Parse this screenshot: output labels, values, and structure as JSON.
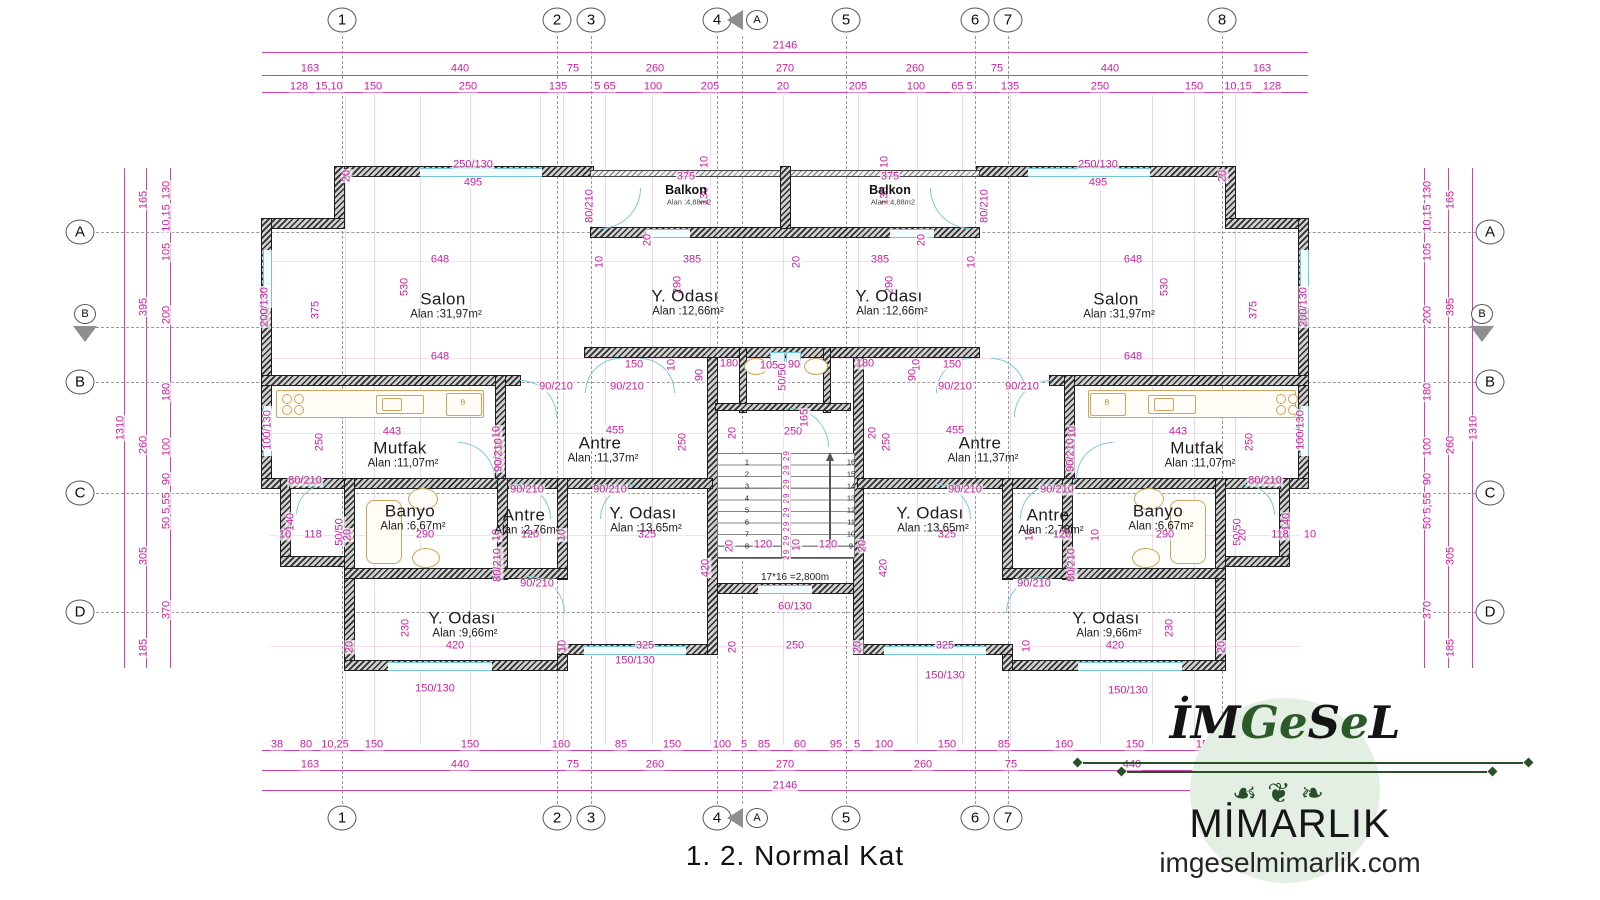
{
  "title": "1. 2. Normal Kat",
  "logo": {
    "parts": [
      {
        "t": "İ",
        "c": "k"
      },
      {
        "t": "M",
        "c": "k"
      },
      {
        "t": "G",
        "c": "g"
      },
      {
        "t": "e",
        "c": "g"
      },
      {
        "t": "S",
        "c": "k"
      },
      {
        "t": "e",
        "c": "g"
      },
      {
        "t": "L",
        "c": "k"
      }
    ],
    "flourish": "☙❦❧",
    "subtitle": "MİMARLIK",
    "website": "imgeselmimarlik.com"
  },
  "colors": {
    "dimension": "#cb1ea0",
    "wall": "#2e2e2e",
    "window": "#74c6d6",
    "fixture": "#cfa45f",
    "logo_green": "#27502a",
    "logo_bg": "#e3efe3"
  },
  "grid": {
    "top_y": 20,
    "bottom_y": 818,
    "left_x": 80,
    "right_x": 1490,
    "cols": [
      {
        "label": "1",
        "x": 342
      },
      {
        "label": "2",
        "x": 557
      },
      {
        "label": "3",
        "x": 591
      },
      {
        "label": "4",
        "x": 717
      },
      {
        "label": "5",
        "x": 846
      },
      {
        "label": "6",
        "x": 975
      },
      {
        "label": "7",
        "x": 1008
      },
      {
        "label": "8",
        "x": 1222
      }
    ],
    "rows": [
      {
        "label": "A",
        "y": 232
      },
      {
        "label": "B",
        "y": 382
      },
      {
        "label": "C",
        "y": 493
      },
      {
        "label": "D",
        "y": 612
      }
    ],
    "markers": [
      {
        "label": "A",
        "cx": 757,
        "cy": 20,
        "tri": "left",
        "tx": 727,
        "ty": 10
      },
      {
        "label": "A",
        "cx": 757,
        "cy": 818,
        "tri": "left",
        "tx": 727,
        "ty": 808
      },
      {
        "label": "B",
        "cx": 85,
        "cy": 314,
        "tri": "down",
        "tx": 73,
        "ty": 326
      },
      {
        "label": "B",
        "cx": 1482,
        "cy": 314,
        "tri": "down",
        "tx": 1470,
        "ty": 326
      }
    ],
    "section_lines": {
      "vertical_x": 742,
      "horizontal_y": 327
    }
  },
  "rooms": [
    {
      "name": "Salon",
      "area": "Alan :31,97m²",
      "x": 443,
      "y": 299
    },
    {
      "name": "Y. Odası",
      "area": "Alan :12,66m²",
      "x": 685,
      "y": 296
    },
    {
      "name": "Y. Odası",
      "area": "Alan :12,66m²",
      "x": 889,
      "y": 296
    },
    {
      "name": "Salon",
      "area": "Alan :31,97m²",
      "x": 1116,
      "y": 299
    },
    {
      "name": "Balkon",
      "area": "Alan :4,88m2",
      "x": 686,
      "y": 190,
      "small": true
    },
    {
      "name": "Balkon",
      "area": "Alan :4,88m2",
      "x": 890,
      "y": 190,
      "small": true
    },
    {
      "name": "Mutfak",
      "area": "Alan :11,07m²",
      "x": 400,
      "y": 448
    },
    {
      "name": "Antre",
      "area": "Alan :11,37m²",
      "x": 600,
      "y": 443
    },
    {
      "name": "Antre",
      "area": "Alan :11,37m²",
      "x": 980,
      "y": 443
    },
    {
      "name": "Mutfak",
      "area": "Alan :11,07m²",
      "x": 1197,
      "y": 448
    },
    {
      "name": "Banyo",
      "area": "Alan :6,67m²",
      "x": 410,
      "y": 511
    },
    {
      "name": "Antre",
      "area": "Alan :2,76m²",
      "x": 524,
      "y": 515
    },
    {
      "name": "Y. Odası",
      "area": "Alan :13,65m²",
      "x": 643,
      "y": 513
    },
    {
      "name": "Y. Odası",
      "area": "Alan :13,65m²",
      "x": 930,
      "y": 513
    },
    {
      "name": "Antre",
      "area": "Alan :2,76m²",
      "x": 1048,
      "y": 515
    },
    {
      "name": "Banyo",
      "area": "Alan :6,67m²",
      "x": 1158,
      "y": 511
    },
    {
      "name": "Y. Odası",
      "area": "Alan :9,66m²",
      "x": 462,
      "y": 618
    },
    {
      "name": "Y. Odası",
      "area": "Alan :9,66m²",
      "x": 1106,
      "y": 618
    }
  ],
  "stair": {
    "note": "17*16 =2,800m",
    "left_steps": [
      "1",
      "2",
      "3",
      "4",
      "5",
      "6",
      "7",
      "8"
    ],
    "right_steps": [
      "16",
      "15",
      "14",
      "13",
      "12",
      "11",
      "10",
      "9"
    ],
    "riser_labels": "29 29 29 29 29 29 29 29"
  },
  "labels": [
    {
      "t": "2146",
      "x": 785,
      "y": 46
    },
    {
      "t": "163",
      "x": 310,
      "y": 69
    },
    {
      "t": "440",
      "x": 460,
      "y": 69
    },
    {
      "t": "75",
      "x": 573,
      "y": 69
    },
    {
      "t": "260",
      "x": 655,
      "y": 69
    },
    {
      "t": "270",
      "x": 785,
      "y": 69
    },
    {
      "t": "260",
      "x": 915,
      "y": 69
    },
    {
      "t": "75",
      "x": 997,
      "y": 69
    },
    {
      "t": "440",
      "x": 1110,
      "y": 69
    },
    {
      "t": "163",
      "x": 1262,
      "y": 69
    },
    {
      "t": "128",
      "x": 299,
      "y": 87
    },
    {
      "t": "15,10",
      "x": 329,
      "y": 87
    },
    {
      "t": "150",
      "x": 373,
      "y": 87
    },
    {
      "t": "250",
      "x": 468,
      "y": 87
    },
    {
      "t": "135",
      "x": 558,
      "y": 87
    },
    {
      "t": "5 65",
      "x": 605,
      "y": 87
    },
    {
      "t": "100",
      "x": 653,
      "y": 87
    },
    {
      "t": "205",
      "x": 710,
      "y": 87
    },
    {
      "t": "20",
      "x": 783,
      "y": 87
    },
    {
      "t": "205",
      "x": 858,
      "y": 87
    },
    {
      "t": "100",
      "x": 916,
      "y": 87
    },
    {
      "t": "65 5",
      "x": 962,
      "y": 87
    },
    {
      "t": "135",
      "x": 1010,
      "y": 87
    },
    {
      "t": "250",
      "x": 1100,
      "y": 87
    },
    {
      "t": "150",
      "x": 1194,
      "y": 87
    },
    {
      "t": "10,15",
      "x": 1238,
      "y": 87
    },
    {
      "t": "128",
      "x": 1272,
      "y": 87
    },
    {
      "t": "38",
      "x": 277,
      "y": 745
    },
    {
      "t": "80",
      "x": 306,
      "y": 745
    },
    {
      "t": "10,25",
      "x": 335,
      "y": 745
    },
    {
      "t": "150",
      "x": 374,
      "y": 745
    },
    {
      "t": "150",
      "x": 470,
      "y": 745
    },
    {
      "t": "160",
      "x": 561,
      "y": 745
    },
    {
      "t": "85",
      "x": 621,
      "y": 745
    },
    {
      "t": "150",
      "x": 672,
      "y": 745
    },
    {
      "t": "100",
      "x": 722,
      "y": 745
    },
    {
      "t": "5",
      "x": 744,
      "y": 745
    },
    {
      "t": "85",
      "x": 764,
      "y": 745
    },
    {
      "t": "60",
      "x": 800,
      "y": 745
    },
    {
      "t": "95",
      "x": 836,
      "y": 745
    },
    {
      "t": "5",
      "x": 857,
      "y": 745
    },
    {
      "t": "100",
      "x": 884,
      "y": 745
    },
    {
      "t": "150",
      "x": 947,
      "y": 745
    },
    {
      "t": "85",
      "x": 1004,
      "y": 745
    },
    {
      "t": "160",
      "x": 1064,
      "y": 745
    },
    {
      "t": "150",
      "x": 1135,
      "y": 745
    },
    {
      "t": "150",
      "x": 1205,
      "y": 745
    },
    {
      "t": "25,080",
      "x": 1262,
      "y": 745
    },
    {
      "t": "38",
      "x": 1300,
      "y": 745
    },
    {
      "t": "163",
      "x": 310,
      "y": 765
    },
    {
      "t": "440",
      "x": 460,
      "y": 765
    },
    {
      "t": "75",
      "x": 573,
      "y": 765
    },
    {
      "t": "260",
      "x": 655,
      "y": 765
    },
    {
      "t": "270",
      "x": 785,
      "y": 765
    },
    {
      "t": "260",
      "x": 923,
      "y": 765
    },
    {
      "t": "75",
      "x": 1011,
      "y": 765
    },
    {
      "t": "440",
      "x": 1132,
      "y": 765
    },
    {
      "t": "163",
      "x": 1280,
      "y": 765
    },
    {
      "t": "2146",
      "x": 785,
      "y": 786
    },
    {
      "t": "130",
      "x": 167,
      "y": 190,
      "r": 1
    },
    {
      "t": "10,15",
      "x": 167,
      "y": 218,
      "r": 1
    },
    {
      "t": "105",
      "x": 167,
      "y": 252,
      "r": 1
    },
    {
      "t": "200",
      "x": 167,
      "y": 315,
      "r": 1
    },
    {
      "t": "180",
      "x": 167,
      "y": 392,
      "r": 1
    },
    {
      "t": "100",
      "x": 167,
      "y": 447,
      "r": 1
    },
    {
      "t": "90",
      "x": 167,
      "y": 479,
      "r": 1
    },
    {
      "t": "5,55",
      "x": 167,
      "y": 503,
      "r": 1
    },
    {
      "t": "50",
      "x": 167,
      "y": 523,
      "r": 1
    },
    {
      "t": "370",
      "x": 167,
      "y": 610,
      "r": 1
    },
    {
      "t": "165",
      "x": 144,
      "y": 200,
      "r": 1
    },
    {
      "t": "395",
      "x": 144,
      "y": 307,
      "r": 1
    },
    {
      "t": "260",
      "x": 144,
      "y": 445,
      "r": 1
    },
    {
      "t": "305",
      "x": 144,
      "y": 556,
      "r": 1
    },
    {
      "t": "185",
      "x": 144,
      "y": 648,
      "r": 1
    },
    {
      "t": "1310",
      "x": 121,
      "y": 428,
      "r": 1
    },
    {
      "t": "130",
      "x": 1428,
      "y": 190,
      "r": 1
    },
    {
      "t": "10,15",
      "x": 1428,
      "y": 218,
      "r": 1
    },
    {
      "t": "105",
      "x": 1428,
      "y": 252,
      "r": 1
    },
    {
      "t": "200",
      "x": 1428,
      "y": 315,
      "r": 1
    },
    {
      "t": "180",
      "x": 1428,
      "y": 392,
      "r": 1
    },
    {
      "t": "100",
      "x": 1428,
      "y": 447,
      "r": 1
    },
    {
      "t": "90",
      "x": 1428,
      "y": 479,
      "r": 1
    },
    {
      "t": "5,55",
      "x": 1428,
      "y": 503,
      "r": 1
    },
    {
      "t": "50",
      "x": 1428,
      "y": 523,
      "r": 1
    },
    {
      "t": "370",
      "x": 1428,
      "y": 610,
      "r": 1
    },
    {
      "t": "165",
      "x": 1451,
      "y": 200,
      "r": 1
    },
    {
      "t": "395",
      "x": 1451,
      "y": 307,
      "r": 1
    },
    {
      "t": "260",
      "x": 1451,
      "y": 445,
      "r": 1
    },
    {
      "t": "305",
      "x": 1451,
      "y": 556,
      "r": 1
    },
    {
      "t": "185",
      "x": 1451,
      "y": 648,
      "r": 1
    },
    {
      "t": "1310",
      "x": 1474,
      "y": 428,
      "r": 1
    },
    {
      "t": "250/130",
      "x": 473,
      "y": 165
    },
    {
      "t": "495",
      "x": 473,
      "y": 183
    },
    {
      "t": "250/130",
      "x": 1098,
      "y": 165
    },
    {
      "t": "495",
      "x": 1098,
      "y": 183
    },
    {
      "t": "375",
      "x": 686,
      "y": 177
    },
    {
      "t": "375",
      "x": 890,
      "y": 177
    },
    {
      "t": "10",
      "x": 705,
      "y": 162,
      "r": 1
    },
    {
      "t": "130",
      "x": 705,
      "y": 196,
      "r": 1
    },
    {
      "t": "10",
      "x": 885,
      "y": 162,
      "r": 1
    },
    {
      "t": "130",
      "x": 885,
      "y": 196,
      "r": 1
    },
    {
      "t": "20",
      "x": 347,
      "y": 176,
      "r": 1
    },
    {
      "t": "20",
      "x": 1223,
      "y": 176,
      "r": 1
    },
    {
      "t": "80/210",
      "x": 590,
      "y": 206,
      "r": 1
    },
    {
      "t": "80/210",
      "x": 985,
      "y": 206,
      "r": 1
    },
    {
      "t": "20",
      "x": 648,
      "y": 240,
      "r": 1
    },
    {
      "t": "20",
      "x": 922,
      "y": 240,
      "r": 1
    },
    {
      "t": "648",
      "x": 440,
      "y": 260
    },
    {
      "t": "10",
      "x": 600,
      "y": 262,
      "r": 1
    },
    {
      "t": "385",
      "x": 692,
      "y": 260
    },
    {
      "t": "20",
      "x": 797,
      "y": 262,
      "r": 1
    },
    {
      "t": "385",
      "x": 880,
      "y": 260
    },
    {
      "t": "10",
      "x": 972,
      "y": 262,
      "r": 1
    },
    {
      "t": "648",
      "x": 1133,
      "y": 260
    },
    {
      "t": "530",
      "x": 405,
      "y": 287,
      "r": 1
    },
    {
      "t": "530",
      "x": 1165,
      "y": 287,
      "r": 1
    },
    {
      "t": "375",
      "x": 316,
      "y": 310,
      "r": 1
    },
    {
      "t": "375",
      "x": 1254,
      "y": 310,
      "r": 1
    },
    {
      "t": "290",
      "x": 678,
      "y": 285,
      "r": 1
    },
    {
      "t": "290",
      "x": 890,
      "y": 285,
      "r": 1
    },
    {
      "t": "200/130",
      "x": 265,
      "y": 307,
      "r": 1
    },
    {
      "t": "200/130",
      "x": 1304,
      "y": 307,
      "r": 1
    },
    {
      "t": "648",
      "x": 440,
      "y": 357
    },
    {
      "t": "648",
      "x": 1133,
      "y": 357
    },
    {
      "t": "150",
      "x": 634,
      "y": 365
    },
    {
      "t": "10",
      "x": 672,
      "y": 365,
      "r": 1
    },
    {
      "t": "180",
      "x": 729,
      "y": 364
    },
    {
      "t": "105",
      "x": 769,
      "y": 366
    },
    {
      "t": "90",
      "x": 794,
      "y": 365
    },
    {
      "t": "180",
      "x": 865,
      "y": 364
    },
    {
      "t": "10",
      "x": 917,
      "y": 365,
      "r": 1
    },
    {
      "t": "150",
      "x": 952,
      "y": 365
    },
    {
      "t": "50/50",
      "x": 783,
      "y": 377,
      "r": 1
    },
    {
      "t": "90",
      "x": 700,
      "y": 375,
      "r": 1
    },
    {
      "t": "90",
      "x": 913,
      "y": 375,
      "r": 1
    },
    {
      "t": "90/210",
      "x": 556,
      "y": 387
    },
    {
      "t": "90/210",
      "x": 627,
      "y": 387
    },
    {
      "t": "90/210",
      "x": 955,
      "y": 387
    },
    {
      "t": "90/210",
      "x": 1022,
      "y": 387
    },
    {
      "t": "443",
      "x": 392,
      "y": 432
    },
    {
      "t": "10",
      "x": 497,
      "y": 432,
      "r": 1
    },
    {
      "t": "455",
      "x": 615,
      "y": 431
    },
    {
      "t": "455",
      "x": 955,
      "y": 431
    },
    {
      "t": "10",
      "x": 1073,
      "y": 432,
      "r": 1
    },
    {
      "t": "443",
      "x": 1178,
      "y": 432
    },
    {
      "t": "250",
      "x": 320,
      "y": 442,
      "r": 1
    },
    {
      "t": "250",
      "x": 683,
      "y": 442,
      "r": 1
    },
    {
      "t": "250",
      "x": 887,
      "y": 442,
      "r": 1
    },
    {
      "t": "250",
      "x": 1250,
      "y": 442,
      "r": 1
    },
    {
      "t": "20",
      "x": 733,
      "y": 433,
      "r": 1
    },
    {
      "t": "250",
      "x": 793,
      "y": 432
    },
    {
      "t": "20",
      "x": 873,
      "y": 433,
      "r": 1
    },
    {
      "t": "165",
      "x": 805,
      "y": 418,
      "r": 1
    },
    {
      "t": "90/210",
      "x": 499,
      "y": 455,
      "r": 1
    },
    {
      "t": "90/210",
      "x": 1071,
      "y": 455,
      "r": 1
    },
    {
      "t": "80/210",
      "x": 305,
      "y": 481
    },
    {
      "t": "80/210",
      "x": 1265,
      "y": 481
    },
    {
      "t": "90/210",
      "x": 527,
      "y": 490
    },
    {
      "t": "90/210",
      "x": 610,
      "y": 490
    },
    {
      "t": "90/210",
      "x": 965,
      "y": 490
    },
    {
      "t": "90/210",
      "x": 1057,
      "y": 490
    },
    {
      "t": "140",
      "x": 291,
      "y": 522,
      "r": 1
    },
    {
      "t": "140",
      "x": 1287,
      "y": 522,
      "r": 1
    },
    {
      "t": "50/50",
      "x": 340,
      "y": 532,
      "r": 1
    },
    {
      "t": "50/50",
      "x": 1238,
      "y": 532,
      "r": 1
    },
    {
      "t": "10",
      "x": 285,
      "y": 535
    },
    {
      "t": "118",
      "x": 313,
      "y": 535
    },
    {
      "t": "20",
      "x": 348,
      "y": 535,
      "r": 1
    },
    {
      "t": "290",
      "x": 425,
      "y": 535
    },
    {
      "t": "10",
      "x": 497,
      "y": 535,
      "r": 1
    },
    {
      "t": "120",
      "x": 530,
      "y": 535
    },
    {
      "t": "10",
      "x": 562,
      "y": 535,
      "r": 1
    },
    {
      "t": "325",
      "x": 647,
      "y": 535
    },
    {
      "t": "325",
      "x": 947,
      "y": 535
    },
    {
      "t": "10",
      "x": 1030,
      "y": 535,
      "r": 1
    },
    {
      "t": "120",
      "x": 1062,
      "y": 535
    },
    {
      "t": "10",
      "x": 1096,
      "y": 535,
      "r": 1
    },
    {
      "t": "290",
      "x": 1165,
      "y": 535
    },
    {
      "t": "20",
      "x": 1243,
      "y": 535,
      "r": 1
    },
    {
      "t": "118",
      "x": 1280,
      "y": 535
    },
    {
      "t": "10",
      "x": 1310,
      "y": 535
    },
    {
      "t": "80/210",
      "x": 498,
      "y": 565,
      "r": 1
    },
    {
      "t": "80/210",
      "x": 1072,
      "y": 565,
      "r": 1
    },
    {
      "t": "90/210",
      "x": 537,
      "y": 584
    },
    {
      "t": "90/210",
      "x": 1034,
      "y": 584
    },
    {
      "t": "230",
      "x": 406,
      "y": 628,
      "r": 1
    },
    {
      "t": "230",
      "x": 1170,
      "y": 628,
      "r": 1
    },
    {
      "t": "100/130",
      "x": 268,
      "y": 430,
      "r": 1
    },
    {
      "t": "100/130",
      "x": 1301,
      "y": 430,
      "r": 1
    },
    {
      "t": "20",
      "x": 350,
      "y": 647,
      "r": 1
    },
    {
      "t": "420",
      "x": 455,
      "y": 646
    },
    {
      "t": "10",
      "x": 563,
      "y": 646,
      "r": 1
    },
    {
      "t": "325",
      "x": 645,
      "y": 646
    },
    {
      "t": "20",
      "x": 733,
      "y": 647,
      "r": 1
    },
    {
      "t": "250",
      "x": 795,
      "y": 646
    },
    {
      "t": "20",
      "x": 858,
      "y": 647,
      "r": 1
    },
    {
      "t": "325",
      "x": 945,
      "y": 646
    },
    {
      "t": "10",
      "x": 1027,
      "y": 646,
      "r": 1
    },
    {
      "t": "420",
      "x": 1115,
      "y": 646
    },
    {
      "t": "20",
      "x": 1222,
      "y": 647,
      "r": 1
    },
    {
      "t": "60/130",
      "x": 795,
      "y": 607
    },
    {
      "t": "150/130",
      "x": 435,
      "y": 689
    },
    {
      "t": "150/130",
      "x": 635,
      "y": 661
    },
    {
      "t": "150/130",
      "x": 945,
      "y": 676
    },
    {
      "t": "150/130",
      "x": 1128,
      "y": 691
    },
    {
      "t": "120",
      "x": 763,
      "y": 545
    },
    {
      "t": "10",
      "x": 797,
      "y": 545,
      "r": 1
    },
    {
      "t": "120",
      "x": 828,
      "y": 545
    },
    {
      "t": "20",
      "x": 730,
      "y": 546,
      "r": 1
    },
    {
      "t": "20",
      "x": 863,
      "y": 546,
      "r": 1
    },
    {
      "t": "420",
      "x": 706,
      "y": 568,
      "r": 1
    },
    {
      "t": "420",
      "x": 884,
      "y": 568,
      "r": 1
    },
    {
      "t": "29 29 29 29 29 29 29 29",
      "x": 787,
      "y": 505,
      "r": 1,
      "c": "dim9"
    },
    {
      "t": "B",
      "x": 463,
      "y": 403,
      "c": "tan"
    },
    {
      "t": "B",
      "x": 1107,
      "y": 403,
      "c": "tan"
    }
  ]
}
